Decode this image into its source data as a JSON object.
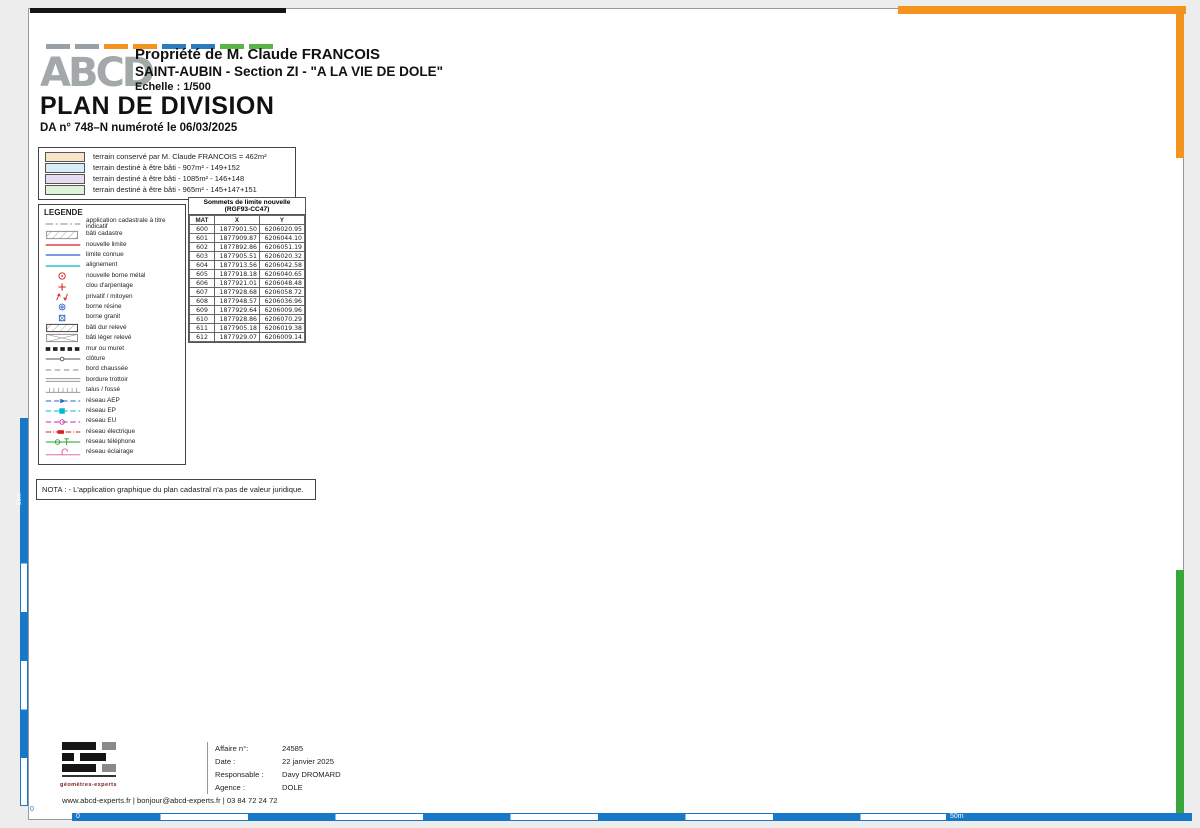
{
  "header": {
    "owner": "Propriété de M. Claude FRANCOIS",
    "location": "SAINT-AUBIN - Section ZI - \"A LA VIE DE DOLE\"",
    "scale": "Echelle : 1/500",
    "doc_title": "PLAN DE DIVISION",
    "doc_ref": "DA n° 748–N numéroté le 06/03/2025",
    "logo_text": "ABCD"
  },
  "colors": {
    "parcel_blue": "#d9edf8",
    "parcel_purple": "#e6ddf3",
    "parcel_green": "#def3da",
    "parcel_orange": "#f8e4c9",
    "new_limit_red": "#d42020",
    "known_limit_blue": "#2b62c9",
    "alignment_cyan": "#00b7d4",
    "frame_orange": "#f5931f",
    "frame_green": "#3aa53a",
    "scale_blue": "#1878c8"
  },
  "color_legend": {
    "rows": [
      {
        "label": "terrain conservé par M. Claude FRANCOIS = 462m²",
        "color": "#f8e4c9"
      },
      {
        "label": "terrain destiné à être bâti - 907m² - 149+152",
        "color": "#d9edf8"
      },
      {
        "label": "terrain destiné à être bâti - 1085m² - 146+148",
        "color": "#e6ddf3"
      },
      {
        "label": "terrain destiné à être bâti - 965m² - 145+147+151",
        "color": "#def3da"
      }
    ]
  },
  "legend": {
    "title": "LEGENDE",
    "items": [
      "application cadastrale à titre indicatif",
      "bâti cadastre",
      "nouvelle limite",
      "limite connue",
      "alignement",
      "nouvelle borne métal",
      "clou d'arpentage",
      "privatif / mitoyen",
      "borne résine",
      "borne granit",
      "bâti dur relevé",
      "bâti léger relevé",
      "mur ou muret",
      "clôture",
      "bord chaussée",
      "bordure trottoir",
      "talus / fossé",
      "réseau AEP",
      "réseau EP",
      "réseau EU",
      "réseau électrique",
      "réseau téléphone",
      "réseau éclairage"
    ]
  },
  "vertex_table": {
    "title1": "Sommets de limite nouvelle",
    "title2": "(RGF93-CC47)",
    "columns": [
      "MAT",
      "X",
      "Y"
    ],
    "rows": [
      [
        "600",
        "1877901.50",
        "6206020.95"
      ],
      [
        "601",
        "1877909.87",
        "6206044.10"
      ],
      [
        "602",
        "1877892.86",
        "6206051.19"
      ],
      [
        "603",
        "1877905.51",
        "6206020.32"
      ],
      [
        "604",
        "1877913.56",
        "6206042.58"
      ],
      [
        "605",
        "1877918.18",
        "6206040.65"
      ],
      [
        "606",
        "1877921.01",
        "6206048.48"
      ],
      [
        "607",
        "1877928.68",
        "6206058.72"
      ],
      [
        "608",
        "1877948.57",
        "6206036.96"
      ],
      [
        "609",
        "1877929.64",
        "6206009.96"
      ],
      [
        "610",
        "1877928.86",
        "6206070.29"
      ],
      [
        "611",
        "1877905.18",
        "6206019.38"
      ],
      [
        "612",
        "1877929.07",
        "6206009.14"
      ]
    ]
  },
  "nota": "NOTA : - L'application graphique du plan cadastral n'a pas de valeur juridique.",
  "title_block": {
    "rows": [
      {
        "label": "Affaire n°:",
        "value": "24585"
      },
      {
        "label": "Date :",
        "value": "22 janvier 2025"
      },
      {
        "label": "Responsable :",
        "value": "Davy DROMARD"
      },
      {
        "label": "Agence :",
        "value": "DOLE"
      }
    ],
    "logo_sub": "géomètres-experts",
    "contact": "www.abcd-experts.fr | bonjour@abcd-experts.fr | 03 84 72 24 72"
  },
  "scale_bar": {
    "zero": "0",
    "fifty": "50m"
  },
  "north": {
    "letter": "N",
    "note": "orientation indicative"
  },
  "plan": {
    "parcels": [
      {
        "id": "ZI 149",
        "note": "Contenance cadastrale : 07a83",
        "x": 540,
        "y": 298
      },
      {
        "id": "ZI 148",
        "note": "Contenance cadastrale : 10a10",
        "x": 744,
        "y": 303
      },
      {
        "id": "ZI 152",
        "note": "Contenance cadastrale : 01a24",
        "x": 560,
        "y": 394
      },
      {
        "id": "ZI 147",
        "note": "Contenance cadastrale : 07a40",
        "x": 713,
        "y": 421
      },
      {
        "id": "ZI 150",
        "note": "Superficie réelle : 462m²",
        "x": 403,
        "y": 481
      },
      {
        "id": "ZI 151",
        "note": "Contenance cadastrale : 23ca",
        "x": 677,
        "y": 510
      },
      {
        "id": "ZI 146",
        "note": "Contenance cadastrale : 75ca",
        "x": 866,
        "y": 552,
        "sx": 881,
        "sy": 569
      },
      {
        "id": "ZI 145",
        "note": "Contenance cadastrale : 02a02",
        "x": 728,
        "y": 658
      }
    ],
    "labels": [
      {
        "t": "26.36",
        "x": 540,
        "y": 263,
        "r": -12,
        "c": "d"
      },
      {
        "t": "13.62",
        "x": 652,
        "y": 252,
        "r": -4,
        "c": "d"
      },
      {
        "t": "27.83",
        "x": 770,
        "y": 247,
        "r": -3,
        "c": "d"
      },
      {
        "t": "0.61",
        "x": 611,
        "y": 273,
        "r": 82,
        "c": "d"
      },
      {
        "t": "22.59",
        "x": 624,
        "y": 330,
        "r": 82,
        "c": "d"
      },
      {
        "t": "28.76",
        "x": 460,
        "y": 362,
        "r": 86,
        "c": "d"
      },
      {
        "t": "24.39",
        "x": 470,
        "y": 512,
        "r": 86,
        "c": "d"
      },
      {
        "t": "24.61",
        "x": 581,
        "y": 512,
        "r": 86,
        "c": "d"
      },
      {
        "t": "23.67",
        "x": 606,
        "y": 512,
        "r": 83,
        "c": "d"
      },
      {
        "t": "18.42",
        "x": 527,
        "y": 436,
        "r": 0,
        "c": "d"
      },
      {
        "t": "3.99",
        "x": 584,
        "y": 452,
        "r": 70,
        "c": "d"
      },
      {
        "t": "5.01",
        "x": 613,
        "y": 434,
        "r": 0,
        "c": "d"
      },
      {
        "t": "8.33",
        "x": 638,
        "y": 414,
        "r": 82,
        "c": "d"
      },
      {
        "t": "29.86",
        "x": 708,
        "y": 379,
        "r": 0,
        "c": "d"
      },
      {
        "t": "32.98",
        "x": 768,
        "y": 481,
        "r": 80,
        "c": "d"
      },
      {
        "t": "61.28",
        "x": 808,
        "y": 460,
        "r": 78,
        "c": "d"
      },
      {
        "t": "26.13",
        "x": 922,
        "y": 227,
        "r": -10,
        "c": "d"
      },
      {
        "t": "14.26",
        "x": 1036,
        "y": 210,
        "r": -7,
        "c": "d"
      },
      {
        "t": "0.52",
        "x": 864,
        "y": 258,
        "r": 78,
        "c": "d"
      },
      {
        "t": "0.48",
        "x": 1080,
        "y": 216,
        "r": 72,
        "c": "d"
      },
      {
        "t": "42.11",
        "x": 1044,
        "y": 322,
        "r": 80,
        "c": "d"
      },
      {
        "t": "29.71",
        "x": 940,
        "y": 418,
        "r": 2,
        "c": "d"
      },
      {
        "t": "12.49",
        "x": 832,
        "y": 532,
        "r": 80,
        "c": "d"
      },
      {
        "t": "9.41",
        "x": 489,
        "y": 561,
        "r": 52,
        "c": "d"
      },
      {
        "t": "10.39",
        "x": 571,
        "y": 552,
        "r": 48,
        "c": "d"
      },
      {
        "t": "19.34",
        "x": 532,
        "y": 587,
        "r": 0,
        "c": "d"
      },
      {
        "t": "3.99",
        "x": 600,
        "y": 590,
        "r": 0,
        "c": "d"
      },
      {
        "t": "26.00",
        "x": 682,
        "y": 588,
        "r": 0,
        "c": "d"
      },
      {
        "t": "4.07",
        "x": 769,
        "y": 586,
        "r": 0,
        "c": "d"
      },
      {
        "t": "1.00",
        "x": 616,
        "y": 570,
        "r": 82,
        "c": "d"
      },
      {
        "t": "1.00",
        "x": 752,
        "y": 566,
        "r": 82,
        "c": "d"
      },
      {
        "t": "1.61",
        "x": 500,
        "y": 461,
        "r": 82,
        "c": "d6"
      },
      {
        "t": "1.32",
        "x": 550,
        "y": 462,
        "r": 82,
        "c": "d6"
      },
      {
        "t": "607",
        "x": 628,
        "y": 266,
        "c": "p"
      },
      {
        "t": "807",
        "x": 841,
        "y": 250,
        "c": "p"
      },
      {
        "t": "602",
        "x": 459,
        "y": 450,
        "c": "p"
      },
      {
        "t": "604",
        "x": 596,
        "y": 432,
        "c": "p"
      },
      {
        "t": "605",
        "x": 637,
        "y": 429,
        "c": "p"
      },
      {
        "t": "606",
        "x": 640,
        "y": 382,
        "c": "p"
      },
      {
        "t": "608",
        "x": 794,
        "y": 378,
        "c": "p"
      },
      {
        "t": "609",
        "x": 763,
        "y": 566,
        "c": "p"
      },
      {
        "t": "613",
        "x": 603,
        "y": 565,
        "c": "p"
      },
      {
        "t": "600",
        "x": 587,
        "y": 596,
        "c": "p"
      },
      {
        "t": "47",
        "x": 452,
        "y": 278,
        "c": "pb"
      },
      {
        "t": "610",
        "x": 599,
        "y": 244,
        "c": "pb"
      },
      {
        "t": "803",
        "x": 678,
        "y": 240,
        "c": "pb"
      },
      {
        "t": "808",
        "x": 859,
        "y": 233,
        "c": "pb"
      },
      {
        "t": "809",
        "x": 990,
        "y": 206,
        "c": "pb"
      },
      {
        "t": "805",
        "x": 836,
        "y": 407,
        "c": "pb"
      },
      {
        "t": "806",
        "x": 828,
        "y": 500,
        "c": "pb"
      },
      {
        "t": "601",
        "x": 566,
        "y": 437,
        "c": "pb"
      },
      {
        "t": "901",
        "x": 451,
        "y": 590,
        "c": "pb"
      },
      {
        "t": "611",
        "x": 613,
        "y": 598,
        "c": "pb"
      },
      {
        "t": "612",
        "x": 741,
        "y": 596,
        "c": "pb"
      },
      {
        "t": "603",
        "x": 777,
        "y": 594,
        "c": "pb"
      },
      {
        "t": "49",
        "x": 256,
        "y": 644,
        "c": "pb"
      },
      {
        "t": "112",
        "x": 666,
        "y": 190,
        "c": "on"
      },
      {
        "t": "113",
        "x": 846,
        "y": 177,
        "c": "on"
      },
      {
        "t": "114",
        "x": 1100,
        "y": 158,
        "c": "on"
      },
      {
        "t": "132",
        "x": 883,
        "y": 313,
        "c": "on"
      },
      {
        "t": "131",
        "x": 999,
        "y": 409,
        "c": "on"
      },
      {
        "t": "79",
        "x": 1104,
        "y": 418,
        "c": "on"
      },
      {
        "t": "130",
        "x": 991,
        "y": 497,
        "c": "on"
      },
      {
        "t": "133",
        "x": 887,
        "y": 468,
        "c": "on"
      },
      {
        "t": "88",
        "x": 591,
        "y": 671,
        "c": "on"
      },
      {
        "t": "87",
        "x": 708,
        "y": 693,
        "c": "on"
      },
      {
        "t": "86",
        "x": 812,
        "y": 680,
        "c": "on"
      },
      {
        "t": "85",
        "x": 966,
        "y": 685,
        "c": "on"
      },
      {
        "t": "83",
        "x": 714,
        "y": 354,
        "c": "sk"
      },
      {
        "t": "84",
        "x": 559,
        "y": 515,
        "c": "sk"
      },
      {
        "t": "82",
        "x": 752,
        "y": 513,
        "c": "sk"
      },
      {
        "t": "Rue",
        "x": 497,
        "y": 610,
        "c": "st"
      },
      {
        "t": "des",
        "x": 576,
        "y": 608,
        "c": "st"
      },
      {
        "t": "Rolots",
        "x": 663,
        "y": 606,
        "c": "st"
      },
      {
        "t": "79",
        "x": 511,
        "y": 451,
        "c": "tg"
      },
      {
        "t": "155",
        "x": 539,
        "y": 451,
        "c": "tg"
      },
      {
        "t": "77",
        "x": 502,
        "y": 539,
        "c": "tg"
      },
      {
        "t": "76",
        "x": 552,
        "y": 537,
        "c": "tg"
      },
      {
        "t": "N",
        "x": 1101,
        "y": 48,
        "c": "nN"
      },
      {
        "t": "orientation indicative",
        "x": 1132,
        "y": 112,
        "r": -110,
        "c": "no"
      }
    ],
    "points": {
      "red": [
        [
          612,
          251
        ],
        [
          848,
          244
        ],
        [
          472,
          443
        ],
        [
          598,
          442
        ],
        [
          630,
          441
        ],
        [
          632,
          386
        ],
        [
          786,
          384
        ],
        [
          758,
          573
        ],
        [
          590,
          583
        ],
        [
          608,
          562
        ]
      ],
      "blue": [
        [
          466,
          282
        ],
        [
          688,
          246
        ],
        [
          856,
          238
        ],
        [
          997,
          212
        ],
        [
          1073,
          206
        ],
        [
          845,
          413
        ],
        [
          826,
          505
        ],
        [
          578,
          444
        ],
        [
          612,
          583
        ],
        [
          745,
          578
        ],
        [
          777,
          579
        ],
        [
          465,
          581
        ],
        [
          263,
          649
        ]
      ]
    }
  }
}
